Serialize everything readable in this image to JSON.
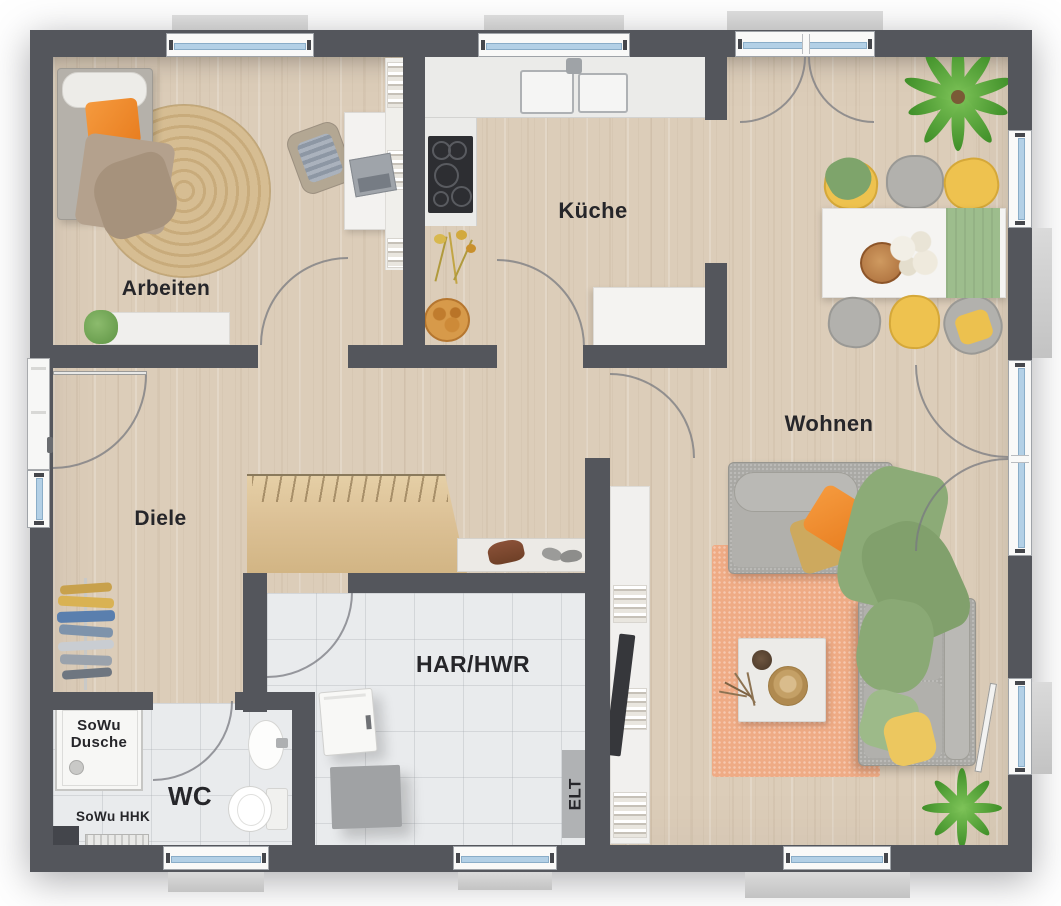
{
  "labels": {
    "arbeiten": "Arbeiten",
    "kueche": "Küche",
    "wohnen": "Wohnen",
    "diele": "Diele",
    "wc": "WC",
    "har_hwr": "HAR/HWR",
    "elt": "ELT",
    "shower_line1": "SoWu",
    "shower_line2": "Dusche",
    "heater": "SoWu HHK"
  },
  "palette": {
    "wall": "#54565c",
    "wood_floor": "#dccdb9",
    "tile_floor": "#e9ebed",
    "window_glass": "#b3d0e6",
    "window_frame": "#f9f9f8",
    "stair_wood": "#ddc49a",
    "rug_jute": "#cfb284",
    "rug_orange": "#efab85",
    "sofa_gray": "#a9a8a4",
    "accent_orange": "#ef8b2e",
    "accent_yellow": "#ecc14f",
    "accent_green": "#8cab77",
    "plant_green": "#5da23e"
  }
}
